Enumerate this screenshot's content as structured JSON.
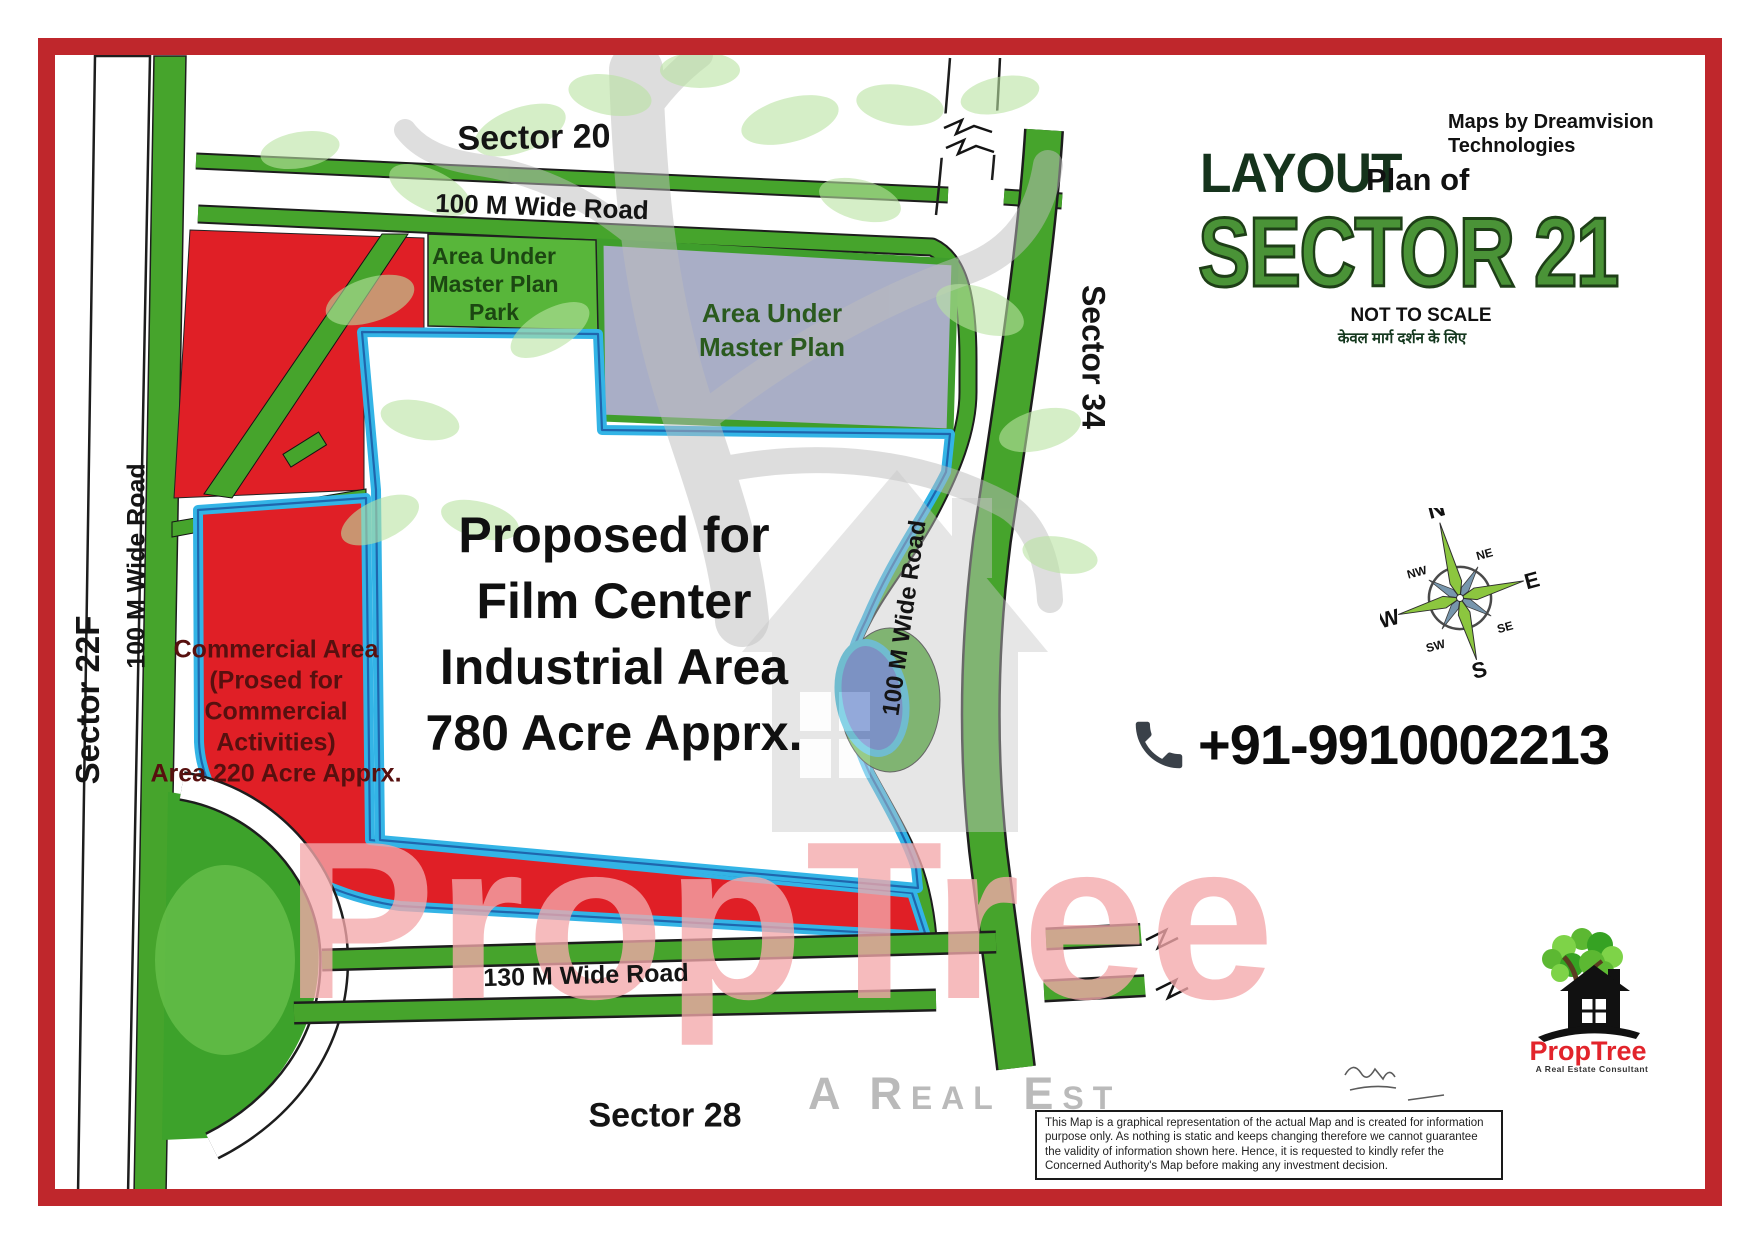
{
  "header": {
    "credit_line1": "Maps by Dreamvision",
    "credit_line2": "Technologies",
    "layout": "LAYOUT",
    "plan_of": "Plan of",
    "sector_title": "SECTOR 21",
    "not_to_scale": "NOT TO SCALE",
    "hindi_note": "केवल मार्ग दर्शन के लिए"
  },
  "contact": {
    "phone": "+91-9910002213"
  },
  "logo": {
    "brand": "PropTree",
    "tagline": "A Real Estate Consultant"
  },
  "watermark": {
    "brand": "PropTree",
    "tagline": "A Real Est"
  },
  "map": {
    "sector_top": "Sector 20",
    "sector_left": "Sector 22F",
    "sector_right": "Sector 34",
    "sector_bottom": "Sector 28",
    "road_top": "100 M Wide Road",
    "road_left": "100 M Wide Road",
    "road_right": "100 M Wide Road",
    "road_bottom": "130 M Wide Road",
    "park_lines": [
      "Area Under",
      "Master Plan",
      "Park"
    ],
    "master_plan_lines": [
      "Area Under",
      "Master Plan"
    ],
    "film_lines": [
      "Proposed for",
      "Film Center",
      "Industrial Area",
      "780 Acre Apprx."
    ],
    "commercial_lines": [
      "Commercial Area",
      "(Prosed for",
      "Commercial",
      "Activities)",
      "Area 220 Acre Apprx."
    ]
  },
  "compass": {
    "n": "N",
    "ne": "NE",
    "e": "E",
    "se": "SE",
    "s": "S",
    "sw": "SW",
    "w": "W",
    "nw": "NW"
  },
  "disclaimer": "This Map is a graphical representation of the actual Map and is created for information purpose only. As nothing is static and keeps changing therefore we cannot guarantee the validity of information shown here. Hence, it is requested to kindly refer the Concerned Authority's Map before making any investment decision.",
  "colors": {
    "frame": "#bf272c",
    "road_green": "#46a42c",
    "map_red": "#e01f26",
    "boundary_cyan": "#33b4e6",
    "boundary_navy": "#1f66ad",
    "master_plan_gray": "#a9aec6",
    "title_green": "#4a9337",
    "brand_red": "#e2242b"
  }
}
